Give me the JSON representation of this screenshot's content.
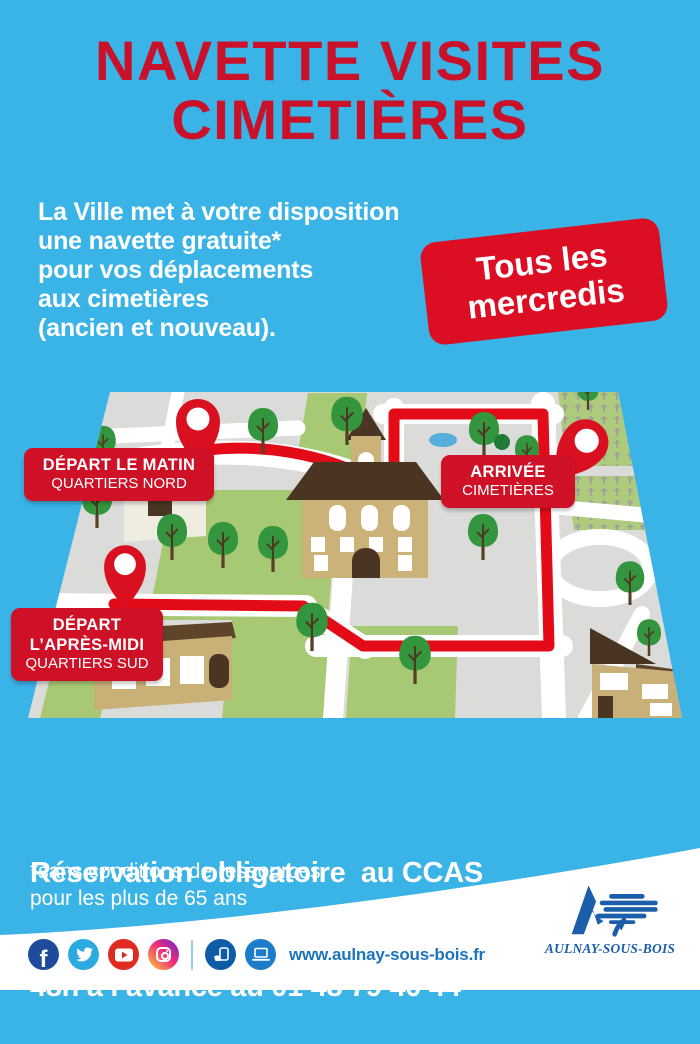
{
  "poster": {
    "title": {
      "line1": "NAVETTE VISITES",
      "line2": "CIMETIÈRES"
    },
    "intro": {
      "lines": [
        "La Ville met à votre disposition",
        "une navette gratuite*",
        "pour vos déplacements",
        "aux cimetières",
        "(ancien et nouveau)."
      ]
    },
    "badge": {
      "line1": "Tous les",
      "line2": "mercredis"
    },
    "map": {
      "depart_matin": {
        "title": "DÉPART LE MATIN",
        "subtitle": "QUARTIERS NORD"
      },
      "arrivee": {
        "title": "ARRIVÉE",
        "subtitle": "CIMETIÈRES"
      },
      "depart_apres_midi": {
        "title_line1": "DÉPART",
        "title_line2": "L’APRÈS-MIDI",
        "subtitle": "QUARTIERS SUD"
      }
    },
    "reservation": {
      "line1": "Réservation obligatoire  au CCAS",
      "line2": "48h à l’avance au 01 48 79 40 44"
    },
    "footnote": {
      "line1": "*sans conditions de ressources",
      "line2": "pour les plus de 65 ans"
    },
    "footer": {
      "website": "www.aulnay-sous-bois.fr",
      "logo_text": "AULNAY-SOUS-BOIS",
      "social_icons": [
        "facebook",
        "twitter",
        "youtube",
        "instagram",
        "mobile-app",
        "website"
      ]
    },
    "colors": {
      "background": "#3AB3E7",
      "title_red": "#C9112A",
      "badge_red": "#DB0E23",
      "label_red": "#CE1126",
      "route_red": "#E30B17",
      "text_white": "#FFFFFF",
      "link_blue": "#1C75BC",
      "logo_blue": "#1B5EA9"
    }
  }
}
